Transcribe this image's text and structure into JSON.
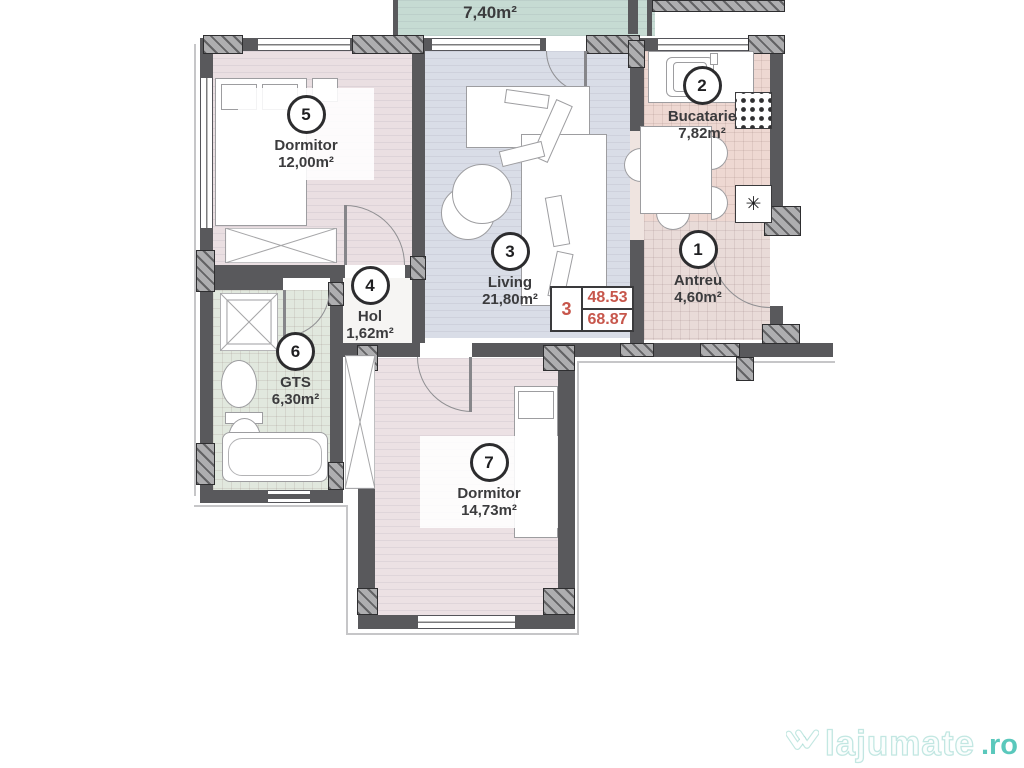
{
  "plan": {
    "balcony": {
      "name": "Balcon",
      "area": "7,40m²"
    },
    "rooms": [
      {
        "number": "1",
        "name": "Antreu",
        "area": "4,60m²"
      },
      {
        "number": "2",
        "name": "Bucatarie",
        "area": "7,82m²"
      },
      {
        "number": "3",
        "name": "Living",
        "area": "21,80m²"
      },
      {
        "number": "4",
        "name": "Hol",
        "area": "1,62m²"
      },
      {
        "number": "5",
        "name": "Dormitor",
        "area": "12,00m²"
      },
      {
        "number": "6",
        "name": "GTS",
        "area": "6,30m²"
      },
      {
        "number": "7",
        "name": "Dormitor",
        "area": "14,73m²"
      }
    ],
    "info_box": {
      "unit_number": "3",
      "useful_area": "48.53",
      "total_area": "68.87"
    },
    "symbols": {
      "fridge": "✳"
    },
    "colors": {
      "wall": "#59595c",
      "accent_red": "#c7564b",
      "floor_bedroom": "#eadfe2",
      "floor_living": "#d9dde7",
      "floor_kitchen": "#eed8d2",
      "floor_antreu": "#e9dbd8",
      "floor_bath": "#e1e8de",
      "floor_bedroom2": "#ece1e4",
      "floor_balcony": "#c6dbd3",
      "watermark_teal": "#49c3b5"
    }
  },
  "watermark": {
    "brand": "lajumate",
    "tld": ".ro"
  }
}
